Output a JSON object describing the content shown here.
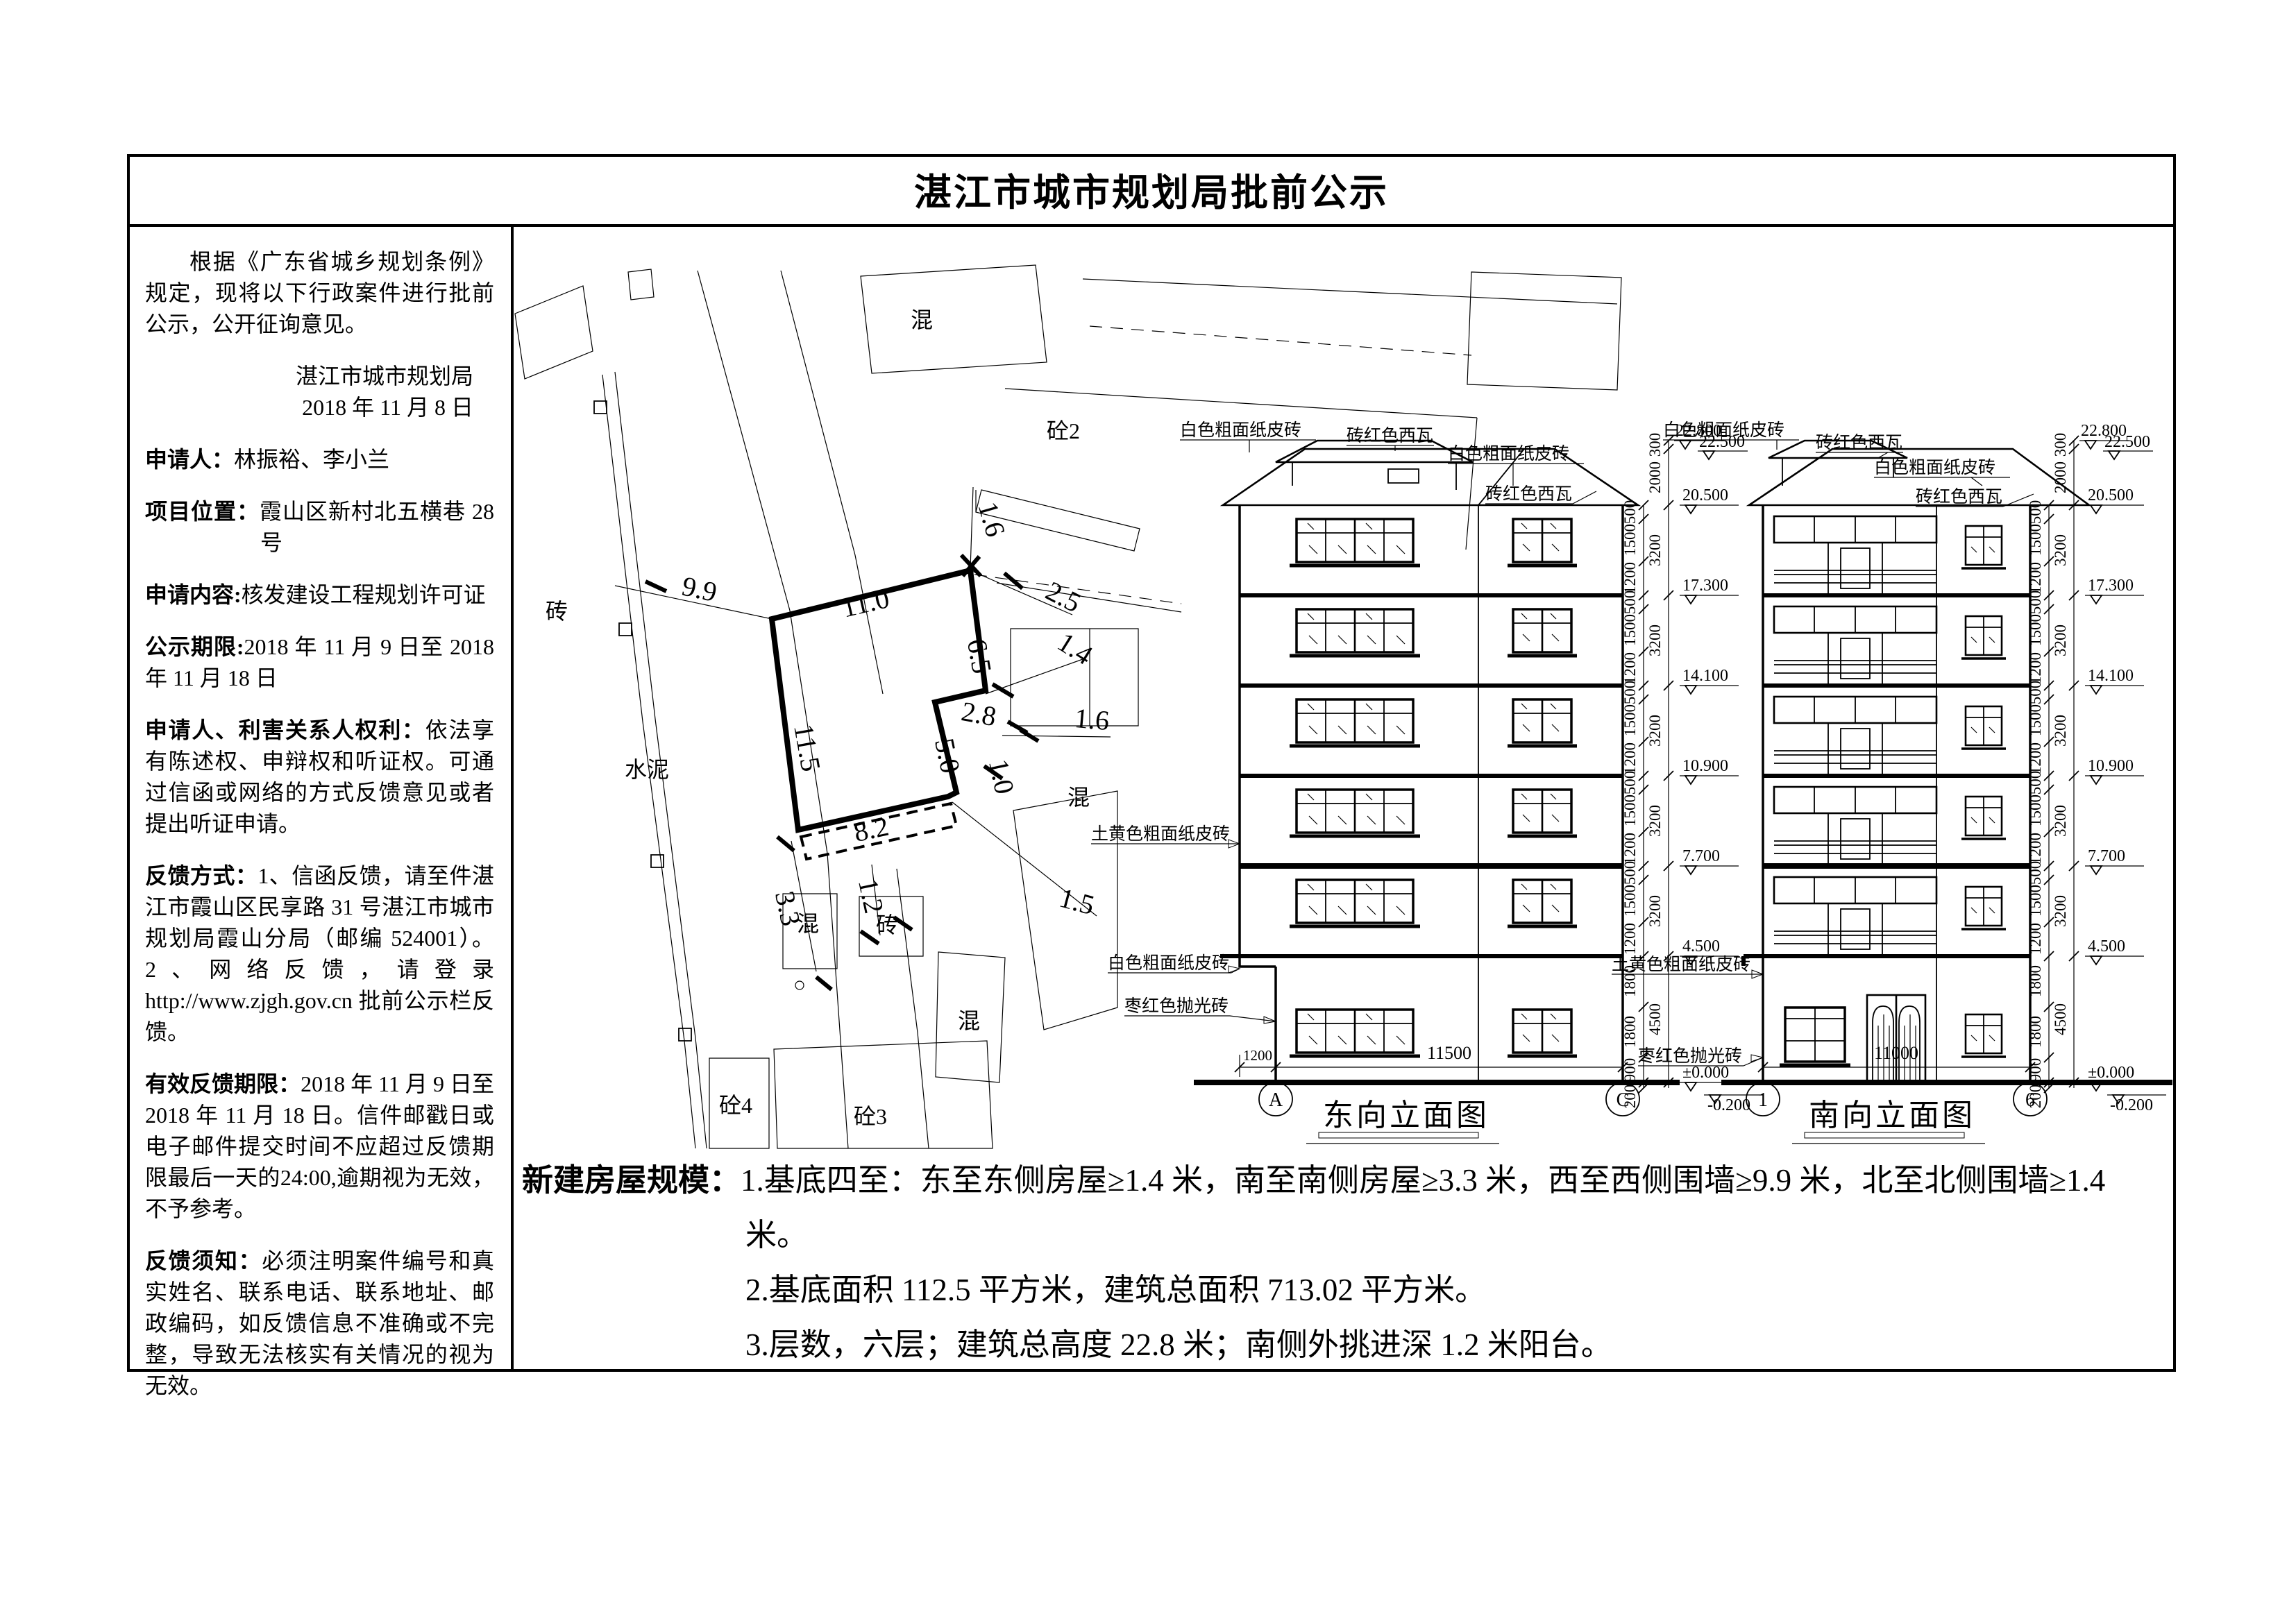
{
  "page": {
    "title": "湛江市城市规划局批前公示"
  },
  "colors": {
    "plot_red": "#ff0000"
  },
  "left_panel": {
    "intro": "根据《广东省城乡规划条例》规定，现将以下行政案件进行批前公示，公开征询意见。",
    "authority": "湛江市城市规划局",
    "date": "2018 年 11 月 8 日",
    "applicant_label": "申请人：",
    "applicant": "林振裕、李小兰",
    "location_label": "项目位置：",
    "location": "霞山区新村北五横巷 28号",
    "content_label": "申请内容:",
    "content": "核发建设工程规划许可证",
    "period_label": "公示期限:",
    "period": "2018 年 11 月 9 日至 2018 年 11 月 18 日",
    "rights_label": "申请人、利害关系人权利：",
    "rights": "依法享有陈述权、申辩权和听证权。可通过信函或网络的方式反馈意见或者提出听证申请。",
    "feedback_label": "反馈方式：",
    "feedback": "1、信函反馈，请至件湛江市霞山区民享路 31 号湛江市城市规划局霞山分局（邮编 524001）。2、网络反馈，请登录 http://www.zjgh.gov.cn 批前公示栏反馈。",
    "valid_label": "有效反馈期限：",
    "valid": "2018 年 11 月 9 日至 2018 年 11 月 18 日。信件邮戳日或电子邮件提交时间不应超过反馈期限最后一天的24:00,逾期视为无效，不予参考。",
    "notice_label": "反馈须知：",
    "notice": "必须注明案件编号和真实姓名、联系电话、联系地址、邮政编码，如反馈信息不准确或不完整，导致无法核实有关情况的视为无效。"
  },
  "notes": {
    "lead": "新建房屋规模：",
    "item1": "1.基底四至：东至东侧房屋≥1.4 米，南至南侧房屋≥3.3 米，西至西侧围墙≥9.9 米，北至北侧围墙≥1.4 米。",
    "item2": "2.基底面积 112.5 平方米，建筑总面积 713.02 平方米。",
    "item3": "3.层数，六层；建筑总高度 22.8 米；南侧外挑进深 1.2 米阳台。"
  },
  "site_plan": {
    "dims": {
      "west": "9.9",
      "north": "11.0",
      "ne": "1.6",
      "e1": "2.5",
      "east": "6.5",
      "e2": "1.4",
      "step": "2.8",
      "e3": "1.6",
      "left": "11.5",
      "s1": "5.0",
      "s2": "1.0",
      "south": "8.2",
      "se": "1.5",
      "sw": "3.3",
      "balc": "1.2"
    },
    "labels": {
      "brick_w": "砖",
      "cement": "水泥",
      "conc_top": "混",
      "conc2": "砼2",
      "conc_e": "混",
      "conc_mid": "混",
      "brick_s": "砖",
      "conc_se": "混",
      "conc4": "砼4",
      "conc3": "砼3",
      "conc_s": "混"
    }
  },
  "materials": {
    "white": "白色粗面纸皮砖",
    "tile": "砖红色西瓦",
    "yellow": "土黄色粗面纸皮砖",
    "maroon": "枣红色抛光砖"
  },
  "elev": {
    "levels": [
      "22.800",
      "22.500",
      "20.500",
      "17.300",
      "14.100",
      "10.900",
      "7.700",
      "4.500",
      "±0.000",
      "-0.200"
    ],
    "outer": [
      "300",
      "2000",
      "3200",
      "4500"
    ],
    "inner": [
      "500",
      "1500",
      "1200"
    ],
    "ground": [
      "1800",
      "1800",
      "900",
      "200"
    ]
  },
  "east": {
    "title": "东向立面图",
    "grid_a": "A",
    "grid_c": "C",
    "dim_balc": "1200",
    "dim_width": "11500"
  },
  "south": {
    "title": "南向立面图",
    "grid_1": "1",
    "grid_6": "6",
    "dim_width": "11000"
  }
}
